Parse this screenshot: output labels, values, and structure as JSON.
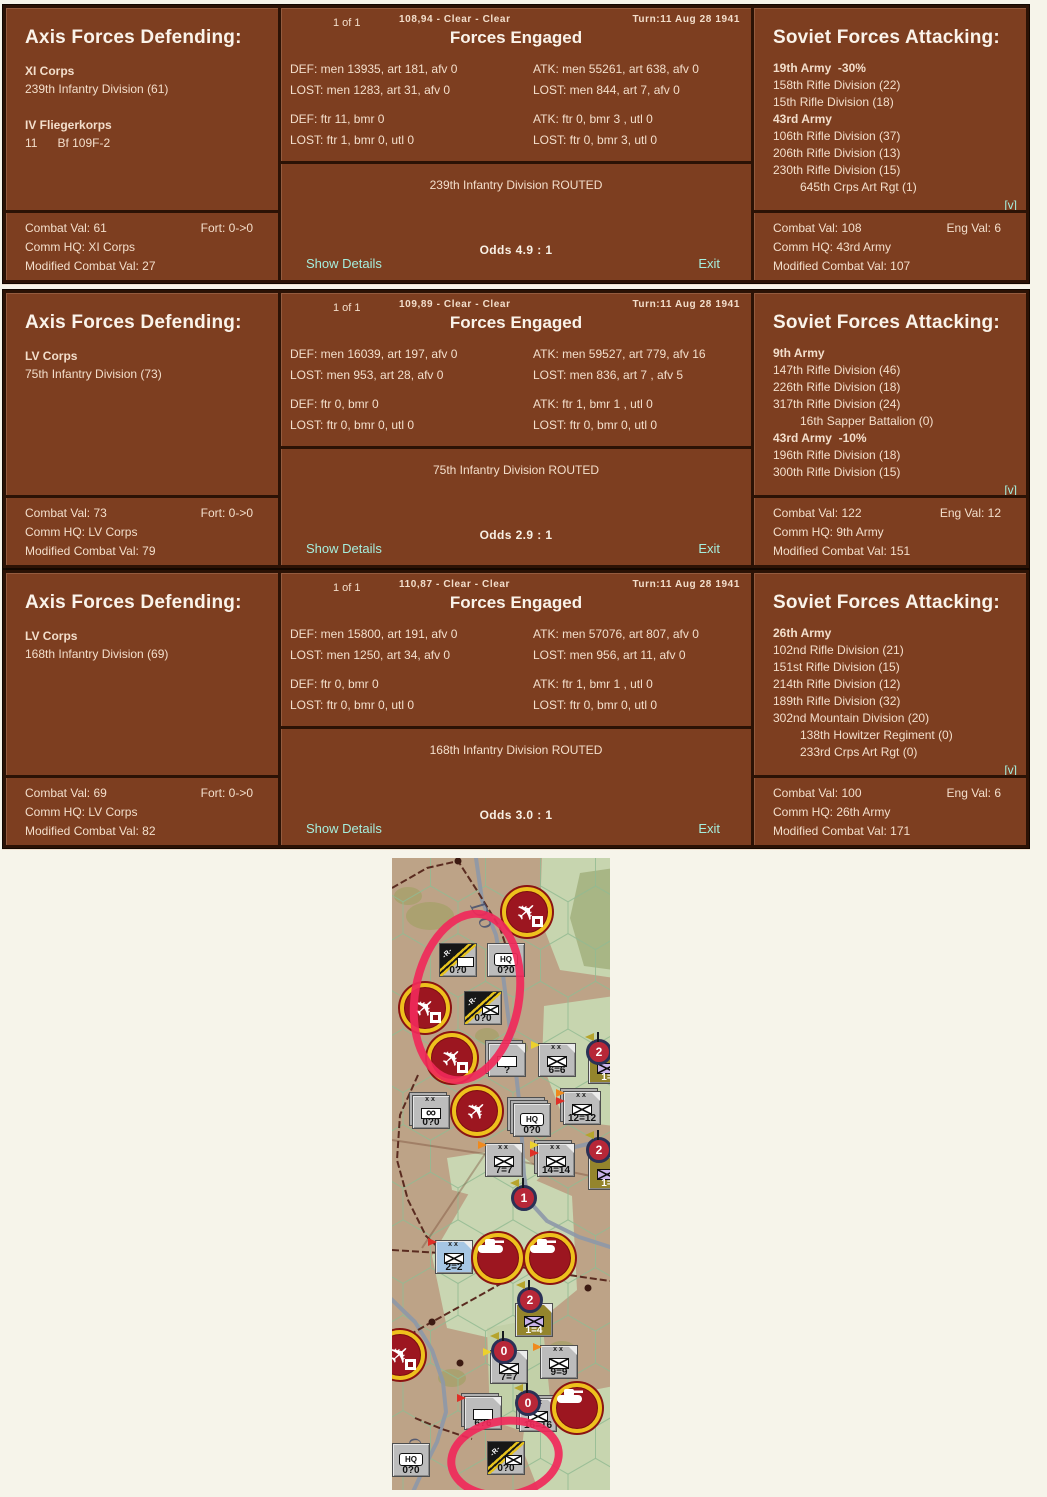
{
  "colors": {
    "panel_brown": "#7d3e20",
    "frame_dark": "#2b1205",
    "link_cyan": "#a5eedd",
    "map_tan": "#bda387",
    "map_green": "#c7d5af",
    "highlight_red": "#f0295a"
  },
  "dialogs": [
    {
      "page_indicator": "1 of 1",
      "hex_info": "108,94 - Clear - Clear",
      "turn_info": "Turn:11  Aug 28 1941",
      "engaged_title": "Forces Engaged",
      "defender": {
        "title": "Axis Forces Defending:",
        "lines": [
          {
            "text": "XI Corps",
            "bold": true
          },
          {
            "text": "239th Infantry Division (61)"
          },
          {
            "text": ""
          },
          {
            "text": "IV Fliegerkorps",
            "bold": true
          },
          {
            "text": "11      Bf 109F-2"
          }
        ],
        "stats": {
          "combat_val": "Combat Val: 61",
          "fort": "Fort: 0->0",
          "comm_hq": "Comm HQ: XI Corps",
          "modified": "Modified Combat Val: 27"
        }
      },
      "engaged": {
        "ground_def": "DEF: men 13935, art 181, afv 0",
        "ground_atk": "ATK: men 55261, art 638, afv 0",
        "ground_def_lost": "LOST: men 1283, art 31, afv 0",
        "ground_atk_lost": "LOST: men 844, art 7, afv 0",
        "air_def": "DEF: ftr 11, bmr 0",
        "air_atk": "ATK: ftr 0, bmr 3 , utl 0",
        "air_def_lost": "LOST: ftr 1, bmr 0, utl 0",
        "air_atk_lost": "LOST: ftr 0, bmr 3, utl 0"
      },
      "result": "239th Infantry Division ROUTED",
      "odds": "Odds 4.9 : 1",
      "show_details": "Show Details",
      "exit": "Exit",
      "expand": "[v]",
      "attacker": {
        "title": "Soviet Forces Attacking:",
        "lines": [
          {
            "text": "19th Army  -30%",
            "bold": true
          },
          {
            "text": "158th Rifle Division (22)"
          },
          {
            "text": "15th Rifle Division (18)"
          },
          {
            "text": "43rd Army",
            "bold": true
          },
          {
            "text": "106th Rifle Division (37)"
          },
          {
            "text": "206th Rifle Division (13)"
          },
          {
            "text": "230th Rifle Division (15)"
          },
          {
            "text": "645th Crps Art Rgt (1)",
            "indent": true
          }
        ],
        "stats": {
          "combat_val": "Combat Val: 108",
          "eng_val": "Eng Val: 6",
          "comm_hq": "Comm HQ: 43rd Army",
          "modified": "Modified Combat Val: 107"
        }
      }
    },
    {
      "page_indicator": "1 of 1",
      "hex_info": "109,89 - Clear - Clear",
      "turn_info": "Turn:11  Aug 28 1941",
      "engaged_title": "Forces Engaged",
      "defender": {
        "title": "Axis Forces Defending:",
        "lines": [
          {
            "text": "LV Corps",
            "bold": true
          },
          {
            "text": "75th Infantry Division (73)"
          }
        ],
        "stats": {
          "combat_val": "Combat Val: 73",
          "fort": "Fort: 0->0",
          "comm_hq": "Comm HQ: LV Corps",
          "modified": "Modified Combat Val: 79"
        }
      },
      "engaged": {
        "ground_def": "DEF: men 16039, art 197, afv 0",
        "ground_atk": "ATK: men 59527, art 779, afv 16",
        "ground_def_lost": "LOST: men 953, art 28, afv 0",
        "ground_atk_lost": "LOST: men 836, art 7 , afv 5",
        "air_def": "DEF: ftr 0, bmr 0",
        "air_atk": "ATK: ftr 1, bmr 1 , utl 0",
        "air_def_lost": "LOST: ftr 0, bmr 0, utl 0",
        "air_atk_lost": "LOST: ftr 0, bmr 0, utl 0"
      },
      "result": "75th Infantry Division ROUTED",
      "odds": "Odds 2.9 : 1",
      "show_details": "Show Details",
      "exit": "Exit",
      "expand": "[v]",
      "attacker": {
        "title": "Soviet Forces Attacking:",
        "lines": [
          {
            "text": "9th Army",
            "bold": true
          },
          {
            "text": "147th Rifle Division (46)"
          },
          {
            "text": "226th Rifle Division (18)"
          },
          {
            "text": "317th Rifle Division (24)"
          },
          {
            "text": "16th Sapper Battalion (0)",
            "indent": true
          },
          {
            "text": "43rd Army  -10%",
            "bold": true
          },
          {
            "text": "196th Rifle Division (18)"
          },
          {
            "text": "300th Rifle Division (15)"
          }
        ],
        "stats": {
          "combat_val": "Combat Val: 122",
          "eng_val": "Eng Val: 12",
          "comm_hq": "Comm HQ: 9th Army",
          "modified": "Modified Combat Val: 151"
        }
      }
    },
    {
      "page_indicator": "1 of 1",
      "hex_info": "110,87 - Clear - Clear",
      "turn_info": "Turn:11  Aug 28 1941",
      "engaged_title": "Forces Engaged",
      "defender": {
        "title": "Axis Forces Defending:",
        "lines": [
          {
            "text": "LV Corps",
            "bold": true
          },
          {
            "text": "168th Infantry Division (69)"
          }
        ],
        "stats": {
          "combat_val": "Combat Val: 69",
          "fort": "Fort: 0->0",
          "comm_hq": "Comm HQ: LV Corps",
          "modified": "Modified Combat Val: 82"
        }
      },
      "engaged": {
        "ground_def": "DEF: men 15800, art 191, afv 0",
        "ground_atk": "ATK: men 57076, art 807, afv 0",
        "ground_def_lost": "LOST: men 1250, art 34, afv 0",
        "ground_atk_lost": "LOST: men 956, art 11, afv 0",
        "air_def": "DEF: ftr 0, bmr 0",
        "air_atk": "ATK: ftr 1, bmr 1 , utl 0",
        "air_def_lost": "LOST: ftr 0, bmr 0, utl 0",
        "air_atk_lost": "LOST: ftr 0, bmr 0, utl 0"
      },
      "result": "168th Infantry Division ROUTED",
      "odds": "Odds 3.0 : 1",
      "show_details": "Show Details",
      "exit": "Exit",
      "expand": "[v]",
      "attacker": {
        "title": "Soviet Forces Attacking:",
        "lines": [
          {
            "text": "26th Army",
            "bold": true
          },
          {
            "text": "102nd Rifle Division (21)"
          },
          {
            "text": "151st Rifle Division (15)"
          },
          {
            "text": "214th Rifle Division (12)"
          },
          {
            "text": "189th Rifle Division (32)"
          },
          {
            "text": "302nd Mountain Division (20)"
          },
          {
            "text": "138th Howitzer Regiment (0)",
            "indent": true
          },
          {
            "text": "233rd Crps Art Rgt (0)",
            "indent": true
          }
        ],
        "stats": {
          "combat_val": "Combat Val: 100",
          "eng_val": "Eng Val: 6",
          "comm_hq": "Comm HQ: 26th Army",
          "modified": "Modified Combat Val: 171"
        }
      }
    }
  ],
  "map": {
    "river_labels": [
      {
        "text": "Do",
        "x": 78,
        "y": 48,
        "size": 20,
        "rot": 62
      },
      {
        "text": "Ga",
        "x": 16,
        "y": 582,
        "size": 15,
        "rot": 68
      }
    ],
    "terrain_patches": [
      {
        "points": "150,-5 222,-5 222,120 168,112 148,60",
        "fill": "#c7d5af"
      },
      {
        "points": "188,15 222,10 222,112 192,108 178,60",
        "fill": "#a8b685"
      },
      {
        "points": "152,148 222,138 222,268 172,262 150,205",
        "fill": "#c7d5af"
      },
      {
        "points": "40,398 80,330 120,312 180,338 185,432 120,485 55,470",
        "fill": "#c9d6b2"
      },
      {
        "points": "55,300 120,290 152,315 120,348 60,332",
        "fill": "#c9d6b2"
      },
      {
        "points": "95,470 150,460 158,540 150,580 98,562",
        "fill": "#c2d0a8"
      },
      {
        "points": "135,545 222,528 222,636 148,636 130,590",
        "fill": "#c7d5af"
      }
    ],
    "speckles": [
      {
        "cx": 38,
        "cy": 58,
        "rx": 24,
        "ry": 14
      },
      {
        "cx": 16,
        "cy": 38,
        "rx": 14,
        "ry": 9
      },
      {
        "cx": 120,
        "cy": 190,
        "rx": 16,
        "ry": 10
      },
      {
        "cx": 95,
        "cy": 178,
        "rx": 12,
        "ry": 8
      },
      {
        "cx": 60,
        "cy": 520,
        "rx": 14,
        "ry": 9
      },
      {
        "cx": 170,
        "cy": 492,
        "rx": 14,
        "ry": 9
      }
    ],
    "rivers": [
      {
        "pts": "84,0 90,42 104,77 111,117 116,157 122,197 127,242 130,282 132,317 136,342 155,363 187,379 218,389"
      },
      {
        "pts": "-5,437 23,464 40,492 51,524 54,554 45,584 32,610 20,636"
      },
      {
        "pts": "170,292 200,285 218,287"
      }
    ],
    "rails": [
      {
        "pts": "0,30 35,10 66,3 86,34 108,70 114,88"
      },
      {
        "pts": "26,217 8,257 5,302 16,342 34,378 50,393"
      },
      {
        "pts": "0,392 48,395 84,401 140,411 190,419 218,423"
      },
      {
        "pts": "0,487 38,465 78,443 110,425"
      },
      {
        "pts": "23,560 50,571 80,581"
      }
    ],
    "rail_dots": [
      {
        "x": 66,
        "y": 3
      },
      {
        "x": 40,
        "y": 464
      },
      {
        "x": 196,
        "y": 430
      },
      {
        "x": 68,
        "y": 505
      }
    ],
    "roads": [
      {
        "pts": "0,282 93,296 218,322"
      },
      {
        "pts": "93,296 30,390"
      }
    ],
    "counters": [
      {
        "x": 47,
        "y": 85,
        "kind": "routed",
        "sym": "plain",
        "label": "0?0"
      },
      {
        "x": 95,
        "y": 85,
        "kind": "hq",
        "label": "0?0"
      },
      {
        "x": 72,
        "y": 133,
        "kind": "routed",
        "sym": "x",
        "label": "0?0"
      },
      {
        "x": 96,
        "y": 185,
        "kind": "blank",
        "label": "?",
        "stack": 1,
        "fold": true
      },
      {
        "x": 146,
        "y": 185,
        "kind": "inf",
        "xx": true,
        "label": "6=6",
        "fold": true,
        "pens": [
          "yl"
        ]
      },
      {
        "x": 196,
        "y": 192,
        "kind": "inf",
        "color": "olv",
        "lav": true,
        "labelcolor": "wh",
        "label": "1=",
        "fold": true
      },
      {
        "x": 20,
        "y": 237,
        "kind": "mot",
        "xx": true,
        "label": "0?0",
        "stack": 1
      },
      {
        "x": 121,
        "y": 245,
        "kind": "hq",
        "label": "0?0",
        "stack": 2
      },
      {
        "x": 171,
        "y": 233,
        "kind": "inf",
        "xx": true,
        "label": "12=12",
        "stack": 1,
        "fold": true,
        "pens": [
          "or",
          "rd"
        ]
      },
      {
        "x": 93,
        "y": 285,
        "kind": "inf",
        "xx": true,
        "label": "7=7",
        "fold": true,
        "pens": [
          "or"
        ]
      },
      {
        "x": 145,
        "y": 285,
        "kind": "inf",
        "xx": true,
        "label": "14=14",
        "stack": 1,
        "fold": true,
        "pens": [
          "yl",
          "rd"
        ]
      },
      {
        "x": 196,
        "y": 298,
        "kind": "inf",
        "color": "olv",
        "lav": true,
        "labelcolor": "wh",
        "label": "1=",
        "fold": true
      },
      {
        "x": 43,
        "y": 382,
        "kind": "inf",
        "xx": true,
        "color": "blu",
        "label": "2=2",
        "fold": true,
        "pens": [
          "rd"
        ]
      },
      {
        "x": 123,
        "y": 445,
        "kind": "inf",
        "color": "olv",
        "lav": true,
        "labelcolor": "wh",
        "label": "1=4",
        "fold": true
      },
      {
        "x": 98,
        "y": 492,
        "kind": "inf",
        "label": "7=7",
        "fold": true,
        "pens": [
          "yl"
        ]
      },
      {
        "x": 148,
        "y": 487,
        "kind": "inf",
        "xx": true,
        "label": "9=9",
        "fold": true,
        "pens": [
          "or"
        ]
      },
      {
        "x": 72,
        "y": 538,
        "kind": "blank",
        "label": "6?6",
        "stack": 1,
        "fold": true,
        "pens": [
          "rd"
        ]
      },
      {
        "x": 127,
        "y": 540,
        "kind": "inf",
        "xx": true,
        "label": "16=16",
        "stack": 1,
        "fold": true
      },
      {
        "x": 0,
        "y": 585,
        "kind": "hq",
        "label": "0?0"
      },
      {
        "x": 95,
        "y": 583,
        "kind": "routed",
        "sym": "x",
        "label": "0?0"
      }
    ],
    "markers": [
      {
        "k": "airb",
        "x": 135,
        "y": 54
      },
      {
        "k": "airb",
        "x": 33,
        "y": 150
      },
      {
        "k": "airb",
        "x": 60,
        "y": 200
      },
      {
        "k": "airf",
        "x": 85,
        "y": 253
      },
      {
        "k": "airb",
        "x": 8,
        "y": 497
      },
      {
        "k": "tank",
        "x": 106,
        "y": 400
      },
      {
        "k": "tank",
        "x": 158,
        "y": 400
      },
      {
        "k": "tank",
        "x": 185,
        "y": 550
      },
      {
        "k": "num",
        "n": "2",
        "x": 207,
        "y": 194
      },
      {
        "k": "num",
        "n": "2",
        "x": 207,
        "y": 292
      },
      {
        "k": "num",
        "n": "1",
        "x": 132,
        "y": 340
      },
      {
        "k": "num",
        "n": "2",
        "x": 138,
        "y": 442
      },
      {
        "k": "num",
        "n": "0",
        "x": 112,
        "y": 493
      },
      {
        "k": "num",
        "n": "0",
        "x": 136,
        "y": 545
      }
    ],
    "highlights": [
      {
        "cx": 75,
        "cy": 139,
        "rx": 48,
        "ry": 80,
        "rot": 10
      },
      {
        "cx": 113,
        "cy": 600,
        "rx": 50,
        "ry": 33,
        "rot": -8
      }
    ]
  }
}
